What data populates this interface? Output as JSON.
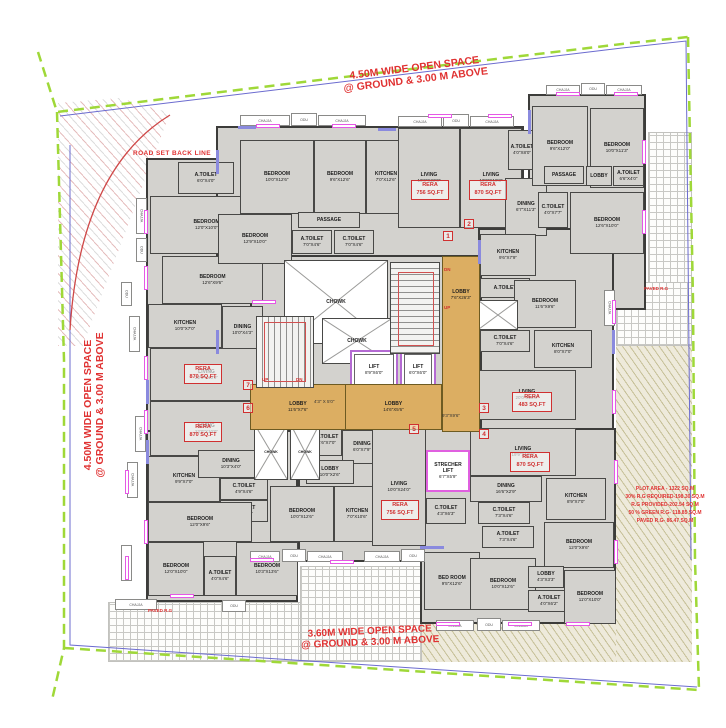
{
  "annotations": {
    "open_space_top_l1": "4.50M WIDE OPEN SPACE",
    "open_space_top_l2": "@ GROUND & 3.00 M ABOVE",
    "open_space_left_l1": "4.50M WIDE OPEN SPACE",
    "open_space_left_l2": "@ GROUND & 3.00 M ABOVE",
    "open_space_bottom_l1": "3.60M WIDE OPEN SPACE",
    "open_space_bottom_l2": "@ GROUND & 3.00 M ABOVE",
    "road_setback": "ROAD SET BACK LINE",
    "paved_rg_left": "PAVED R.G",
    "paved_rg_right": "PAVED R.G",
    "plot_stats": [
      "PLOT AREA - 1322 SQ.M",
      "30% R.G REQUIRED-198.30 SQ.M",
      "R.G PROVIDED-202.54 SQ.M",
      "50 % GREEN R.G- 118.85 SQ.M",
      "PAVED R.G- 86.47 SQ.M"
    ]
  },
  "colors": {
    "annotation_red": "#e03232",
    "lobby_tan": "#dcae62",
    "room_gray": "#d3d2ce",
    "boundary_green": "#9fd838",
    "window_magenta": "#e558e5"
  },
  "units": [
    "1",
    "2",
    "3",
    "4",
    "5",
    "6",
    "7"
  ],
  "rera": {
    "label": "RERA",
    "values": [
      "756 SQ.FT",
      "870 SQ.FT",
      "870 SQ.FT",
      "870 SQ.FT",
      "483 SQ.FT",
      "870 SQ.FT",
      "756 SQ.FT"
    ]
  },
  "stairs": {
    "up": "UP",
    "dn": "DN"
  },
  "extra_dims": [
    "4'3\" X 5'0\"",
    "9'3\"X9'6\""
  ],
  "fixtures": [
    "CHAJJA",
    "ODU",
    "CHAJJA",
    "CHAJJA",
    "ODU",
    "CHAJJA",
    "CHAJJA",
    "ODU",
    "CHAJJA",
    "CHAJJA",
    "ODU",
    "ODU",
    "CHAJJA",
    "CHAJJA",
    "CHAJJA",
    "CHAJJA",
    "CHAJJA",
    "ODU",
    "CHAJJA",
    "ODU",
    "CHAJJA",
    "CHAJJA",
    "ODU",
    "CHAJJA",
    "ODU",
    "CHAJJA",
    "CHAJJA"
  ],
  "rooms": [
    {
      "label": "A.TOILET",
      "dims": "6'0\"X4'0\""
    },
    {
      "label": "BEDROOM",
      "dims": "12'0\"X10'0\""
    },
    {
      "label": "BEDROOM",
      "dims": "12'6\"X9'6\""
    },
    {
      "label": "KITCHEN",
      "dims": "10'0\"X7'0\""
    },
    {
      "label": "DINING",
      "dims": "10'0\"X4'3\""
    },
    {
      "label": "LIVING",
      "dims": "22'6\"X10'0\""
    },
    {
      "label": "LIVING",
      "dims": "22'0\"X10'0\""
    },
    {
      "label": "KITCHEN",
      "dims": "9'9\"X7'0\""
    },
    {
      "label": "DINING",
      "dims": "10'3\"X4'0\""
    },
    {
      "label": "C.TOILET",
      "dims": "4'9\"X4'6\""
    },
    {
      "label": "A.TOILET",
      "dims": "4'9\"X4'6\""
    },
    {
      "label": "BEDROOM",
      "dims": "12'0\"X9'6\""
    },
    {
      "label": "BEDROOM",
      "dims": "12'0\"X10'0\""
    },
    {
      "label": "A.TOILET",
      "dims": "4'0\"X4'6\""
    },
    {
      "label": "BEDROOM",
      "dims": "10'3\"X13'6\""
    },
    {
      "label": "BEDROOM",
      "dims": "10'0\"X12'6\""
    },
    {
      "label": "BEDROOM",
      "dims": "9'6\"X12'6\""
    },
    {
      "label": "KITCHEN",
      "dims": "7'0\"X12'6\""
    },
    {
      "label": "BEDROOM",
      "dims": "12'9\"X10'0\""
    },
    {
      "label": "A.TOILET",
      "dims": "7'0\"X4'6\""
    },
    {
      "label": "C.TOILET",
      "dims": "7'0\"X4'6\""
    },
    {
      "label": "PASSAGE",
      "dims": ""
    },
    {
      "label": "LIVING",
      "dims": "10'0\"X22'0\""
    },
    {
      "label": "LIVING",
      "dims": "10'0\"X18'3\""
    },
    {
      "label": "DINING",
      "dims": "6'7\"X11'3\""
    },
    {
      "label": "A.TOILET",
      "dims": "4'0\"X8'0\""
    },
    {
      "label": "BEDROOM",
      "dims": "9'6\"X12'0\""
    },
    {
      "label": "BEDROOM",
      "dims": "10'0\"X11'3\""
    },
    {
      "label": "PASSAGE",
      "dims": "8'0\"X3'3\""
    },
    {
      "label": "LOBBY",
      "dims": "3'9\"X4'3\""
    },
    {
      "label": "A.TOILET",
      "dims": "6'6\"X4'0\""
    },
    {
      "label": "C.TOILET",
      "dims": "4'0\"X7'7\""
    },
    {
      "label": "BEDROOM",
      "dims": "12'6\"X10'0\""
    },
    {
      "label": "KITCHEN",
      "dims": "9'6\"X7'9\""
    },
    {
      "label": "A.TOILET",
      "dims": "7'0\"X4'0\""
    },
    {
      "label": "BEDROOM",
      "dims": "11'6\"X9'6\""
    },
    {
      "label": "KITCHEN",
      "dims": "8'0\"X7'0\""
    },
    {
      "label": "C.TOILET",
      "dims": "7'0\"X4'6\""
    },
    {
      "label": "LIVING",
      "dims": "20'0\"X10'0\""
    },
    {
      "label": "A.TOILET",
      "dims": "4'6\"X7'0\""
    },
    {
      "label": "DINING",
      "dims": "6'0\"X7'9\""
    },
    {
      "label": "LOBBY",
      "dims": "10'0\"X2'6\""
    },
    {
      "label": "BEDROOM",
      "dims": "10'0\"X12'6\""
    },
    {
      "label": "KITCHEN",
      "dims": "7'0\"X10'6\""
    },
    {
      "label": "LIVING",
      "dims": "10'0\"X24'0\""
    },
    {
      "label": "STRECHER LIFT",
      "dims": "6'7\"X5'9\""
    },
    {
      "label": "C.TOILET",
      "dims": "4'3\"X6'3\""
    },
    {
      "label": "BED ROOM",
      "dims": "9'5\"X12'6\""
    },
    {
      "label": "LIVING",
      "dims": "19'9\"X10'0\""
    },
    {
      "label": "DINING",
      "dims": "16'6\"X2'9\""
    },
    {
      "label": "KITCHEN",
      "dims": "8'9\"X7'0\""
    },
    {
      "label": "C.TOILET",
      "dims": "7'3\"X4'6\""
    },
    {
      "label": "A.TOILET",
      "dims": "7'3\"X4'6\""
    },
    {
      "label": "BEDROOM",
      "dims": "12'0\"X9'6\""
    },
    {
      "label": "BEDROOM",
      "dims": "10'0\"X12'6\""
    },
    {
      "label": "A.TOILET",
      "dims": "4'0\"X6'2\""
    },
    {
      "label": "LOBBY",
      "dims": "4'3\"X3'3\""
    },
    {
      "label": "BEDROOM",
      "dims": "11'0\"X10'0\""
    },
    {
      "label": "CHOWK",
      "dims": ""
    },
    {
      "label": "CHOWK",
      "dims": ""
    },
    {
      "label": "CHOWK",
      "dims": ""
    },
    {
      "label": "CHOWK",
      "dims": ""
    },
    {
      "label": "LIFT",
      "dims": "8'9\"X6'0\""
    },
    {
      "label": "LIFT",
      "dims": "6'0\"X6'0\""
    },
    {
      "label": "LOBBY",
      "dims": "7'6\"X26'3\""
    },
    {
      "label": "LOBBY",
      "dims": "11'6\"X7'6\""
    },
    {
      "label": "LOBBY",
      "dims": "14'6\"X5'6\""
    }
  ]
}
